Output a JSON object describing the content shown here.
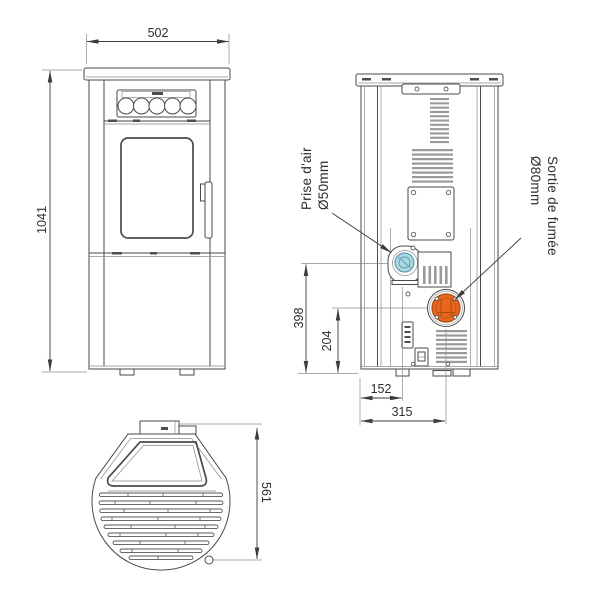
{
  "drawing": {
    "views": {
      "front": {
        "width": "502",
        "height": "1041"
      },
      "back": {
        "air_inlet_height": "398",
        "smoke_outlet_height": "204",
        "air_inlet_offset": "152",
        "smoke_outlet_offset": "315",
        "air_inlet_label": "Prise d'air",
        "air_inlet_diameter": "Ø50mm",
        "smoke_outlet_label": "Sortie de fumée",
        "smoke_outlet_diameter": "Ø80mm"
      },
      "top": {
        "depth": "561"
      }
    },
    "colors": {
      "air_inlet_fill": "#a9d9e2",
      "air_inlet_stroke": "#4e8fa0",
      "smoke_outlet_fill": "#e8671c",
      "smoke_outlet_stroke": "#a84a12"
    }
  }
}
